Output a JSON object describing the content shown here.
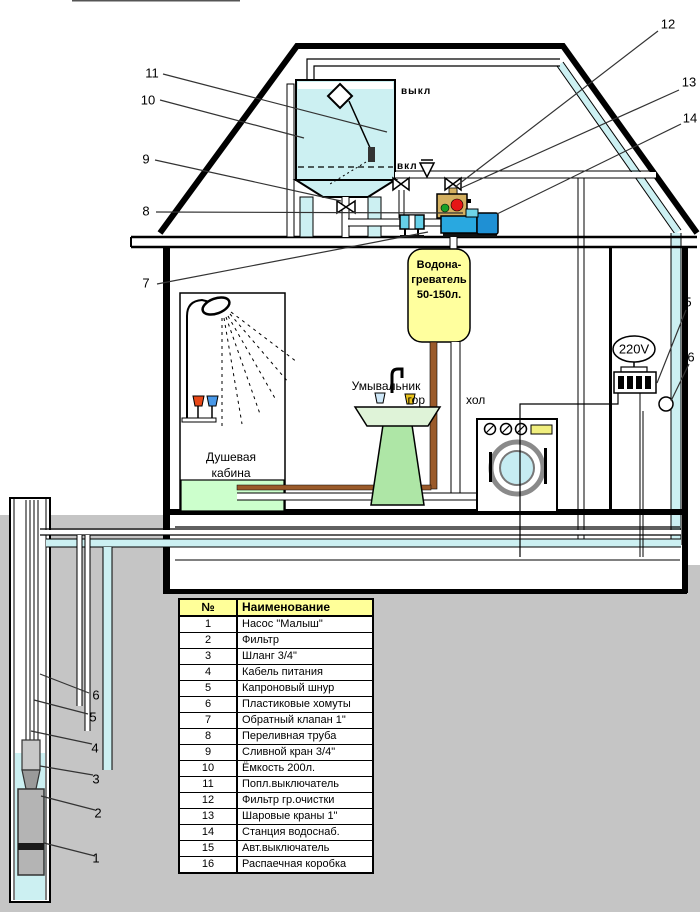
{
  "callouts": {
    "well_1": "1",
    "well_2": "2",
    "well_3": "3",
    "well_4": "4",
    "well_5": "5",
    "well_6": "6",
    "attic_7": "7",
    "attic_8": "8",
    "attic_9": "9",
    "attic_10": "10",
    "attic_11": "11",
    "top_12": "12",
    "top_13": "13",
    "top_14": "14",
    "right_breaker": "5",
    "right_junction": "6"
  },
  "labels": {
    "tank_off": "выкл",
    "tank_on": "вкл",
    "voltage": "220V",
    "heater_line1": "Водона-",
    "heater_line2": "греватель",
    "heater_line3": "50-150л.",
    "hot": "гор",
    "cold": "хол",
    "sink": "Умывальник",
    "shower_line1": "Душевая",
    "shower_line2": "кабина"
  },
  "table": {
    "headers": {
      "num": "№",
      "name": "Наименование"
    },
    "rows": [
      {
        "num": "1",
        "name": "Насос \"Малыш\""
      },
      {
        "num": "2",
        "name": "Фильтр"
      },
      {
        "num": "3",
        "name": "Шланг 3/4\""
      },
      {
        "num": "4",
        "name": "Кабель питания"
      },
      {
        "num": "5",
        "name": "Капроновый шнур"
      },
      {
        "num": "6",
        "name": "Пластиковые хомуты"
      },
      {
        "num": "7",
        "name": "Обратный клапан 1\""
      },
      {
        "num": "8",
        "name": "Переливная труба"
      },
      {
        "num": "9",
        "name": "Сливной кран 3/4\""
      },
      {
        "num": "10",
        "name": "Ёмкость 200л."
      },
      {
        "num": "11",
        "name": "Попл.выключатель"
      },
      {
        "num": "12",
        "name": "Фильтр гр.очистки"
      },
      {
        "num": "13",
        "name": "Шаровые краны 1\""
      },
      {
        "num": "14",
        "name": "Станция водоснаб."
      },
      {
        "num": "15",
        "name": "Авт.выключатель"
      },
      {
        "num": "16",
        "name": "Распаечная коробка"
      }
    ]
  },
  "colors": {
    "ground": "#c5c5c5",
    "water": "#ccf0f2",
    "heater_yellow": "#ffff9e",
    "table_header": "#ffff99",
    "pump_blue": "#29a8e0",
    "motor_blue": "#1f90d4",
    "filter_tan": "#d4b060",
    "indicator_red": "#e61616",
    "indicator_green": "#18a028",
    "check_valve": "#66d0e8",
    "hot_pipe": "#9a5a2a",
    "shower_base": "#ccffcc",
    "sink_green": "#aee6a6",
    "tap_red": "#e84818",
    "tap_blue": "#4898e8",
    "tap_yellow": "#e8c21c",
    "washer_door": "#c6ecf2",
    "washer_display": "#f0ee7e"
  }
}
